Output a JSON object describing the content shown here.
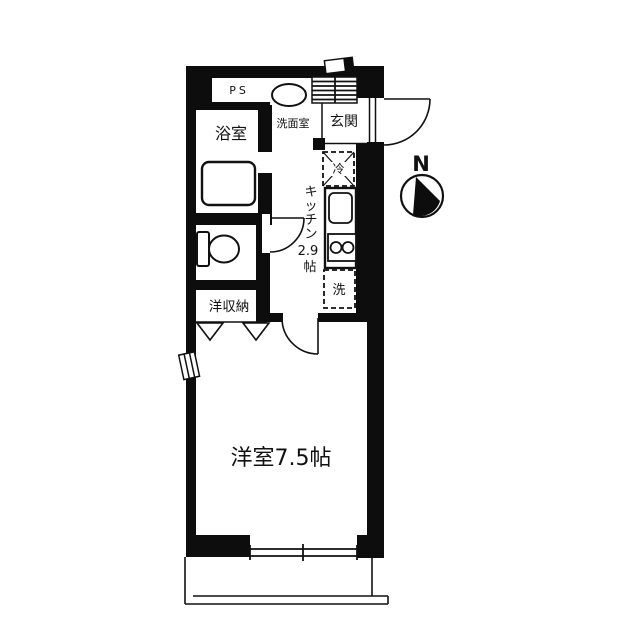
{
  "title": "apartment-floor-plan",
  "compass": {
    "label": "N"
  },
  "rooms": {
    "ps": {
      "label": "PS"
    },
    "bathroom": {
      "label": "浴室"
    },
    "washroom": {
      "label": "洗面室"
    },
    "entrance": {
      "label": "玄関"
    },
    "kitchen": {
      "full_label": "キッチン2.9帖",
      "label_chars": [
        "キ",
        "ッ",
        "チ",
        "ン"
      ],
      "size": "2.9",
      "unit": "帖"
    },
    "closet": {
      "label": "洋収納"
    },
    "main_room": {
      "label": "洋室7.5帖"
    }
  },
  "fixtures": {
    "fridge": {
      "label": "冷"
    },
    "washer": {
      "label": "洗"
    }
  },
  "colors": {
    "wall": "#0d0d0d",
    "line": "#111111",
    "background": "#ffffff"
  }
}
